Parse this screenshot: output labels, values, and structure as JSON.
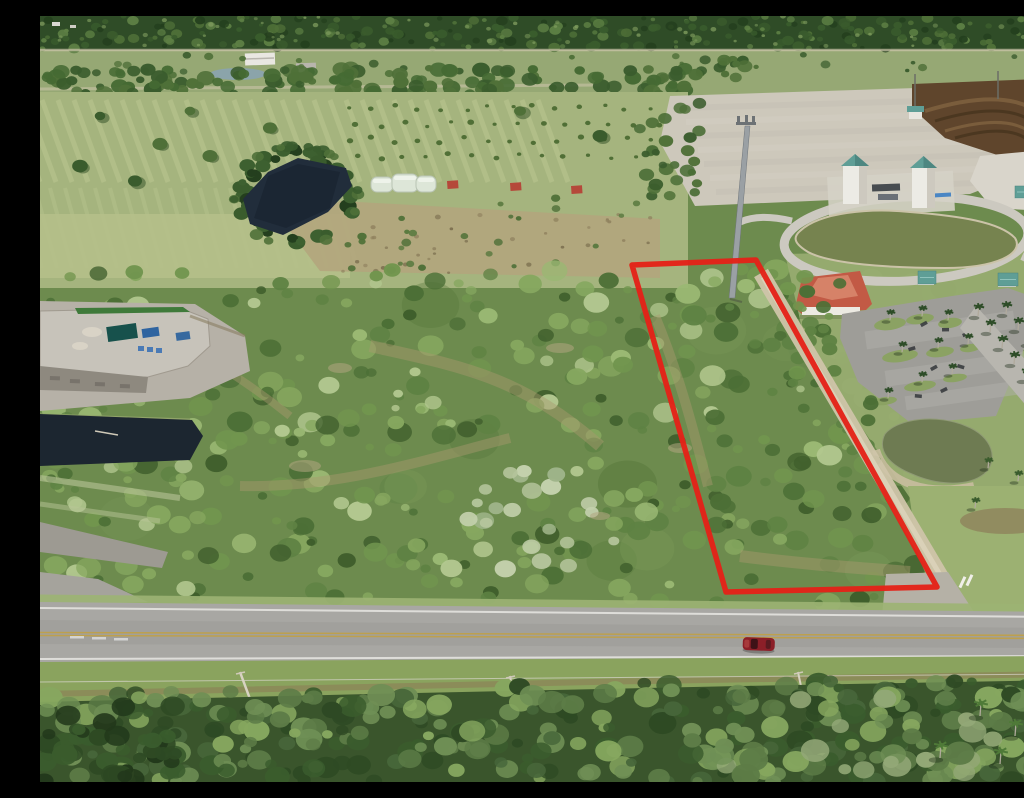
{
  "image": {
    "type": "aerial-drone-photograph",
    "width": 1024,
    "height": 766
  },
  "scene": {
    "description": "Oblique aerial photo of a vacant scrub-covered land parcel outlined in red beside a rural two-lane highway, with farm fields and ponds beyond, a cleared pad with twin water towers, retention ponds, a red-roof building with palm-lined parking to the east, a transfer station to the west, and forest strips at top and bottom",
    "objects": [
      "pine-forest-treeline",
      "pasture-fields",
      "farm-buildings",
      "irrigation-pond",
      "greenhouses",
      "red-roof-sheds",
      "cleared-construction-pad",
      "excavated-dirt-berms",
      "water-towers",
      "retention-pond",
      "teal-roof-pavilions",
      "red-roof-building",
      "palm-lined-parking-lot",
      "entrance-road-palms",
      "second-retention-pond",
      "cell-tower-monopole",
      "scrub-vegetation",
      "drainage-canal",
      "transfer-station",
      "dirt-access-track",
      "driveway-apron",
      "two-lane-highway",
      "double-yellow-line",
      "red-sedan",
      "utility-poles",
      "power-line",
      "roadside-grass-strip",
      "bottom-forest-canopy",
      "parcel-boundary-outline"
    ]
  },
  "annotations": {
    "parcel_outline": {
      "color": "#e42218",
      "shape": "quadrilateral",
      "vertices": [
        [
          592,
          249
        ],
        [
          716,
          244
        ],
        [
          897,
          571
        ],
        [
          686,
          576
        ]
      ]
    }
  },
  "palette": {
    "scrub_base": "#6d8b4e",
    "field_top": "#96a874",
    "field_light": "#a5b47e",
    "field_stripe": "#c3cd97",
    "forest_dark": "#2f4c27",
    "forest_blob1": "#243f1e",
    "forest_blob2": "#3a5c2d",
    "forest_blob3": "#4f7038",
    "forest_blob4": "#5d7f44",
    "forest_light": "#7f9c5e",
    "pond_dark": "#212d3b",
    "pond_olive": "#76834f",
    "pond_olive2": "#6e7b52",
    "pad": "#cdc8bb",
    "dirt_brown": "#5f452c",
    "concrete": "#d9d5cb",
    "teal_roof": "#5f9e96",
    "red_roof": "#c25a45",
    "white_wall": "#eceae2",
    "asphalt": "#a8a7a3",
    "parking": "#9e9d98",
    "yellow_line": "#bfa14a",
    "white_line": "#e4e3df",
    "track": "#cfc5a9",
    "grass_right": "#9cb172",
    "grass_south": "#8aa35e",
    "canal": "#1c2630",
    "station_deck": "#c7c3ba",
    "station_wall": "#8e897f",
    "canopy_teal": "#17514c",
    "bin_blue": "#2f64a0",
    "car_red": "#8c1f28",
    "tan_corridor": "#a89a6e",
    "palm_green": "#2e4d28",
    "outline_red": "#e42218"
  }
}
